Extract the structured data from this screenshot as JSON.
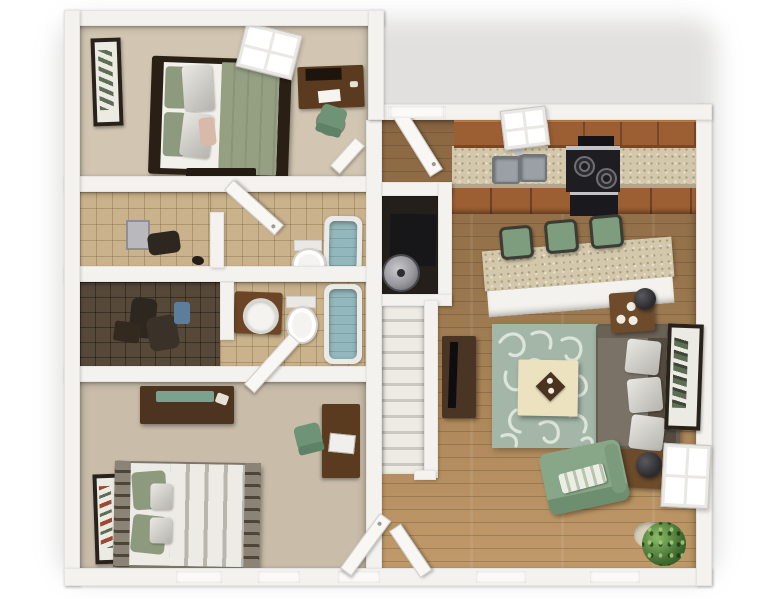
{
  "visible_text": [],
  "scene": {
    "type": "3d-apartment-floor-plan-render",
    "view": "top-down dollhouse cutaway, white exterior walls on white background",
    "rooms": [
      {
        "id": "bedroom-1",
        "position": "top-left",
        "floor": "beige carpet",
        "furniture": [
          "wall-art",
          "double-bed-sage-duvet",
          "white-pillows",
          "pink-accent-pillow",
          "foot-bench",
          "four-pane-window",
          "desk",
          "green-office-chair"
        ]
      },
      {
        "id": "closet-a",
        "position": "mid-left",
        "floor": "tan tile",
        "furniture": [
          "grey-wall-cabinet",
          "hanging-clothes"
        ]
      },
      {
        "id": "bathroom-a",
        "position": "mid-center-left",
        "floor": "tan tile",
        "furniture": [
          "open-door",
          "bathtub",
          "toilet"
        ]
      },
      {
        "id": "walk-in-closet",
        "position": "lower-mid-left",
        "floor": "dark tile",
        "furniture": [
          "hanging-clothes",
          "blue-towels",
          "bench"
        ]
      },
      {
        "id": "bathroom-b",
        "position": "lower-mid-center",
        "floor": "tan tile",
        "furniture": [
          "vanity-with-round-sink",
          "toilet",
          "bathtub",
          "open-door"
        ]
      },
      {
        "id": "bedroom-2",
        "position": "bottom-left",
        "floor": "taupe carpet",
        "furniture": [
          "dresser-with-teal-runner",
          "wall-art",
          "striped-duvet-bed",
          "sage-pillows",
          "desk",
          "green-office-chair",
          "two-windows",
          "open-door"
        ]
      },
      {
        "id": "utility-closet",
        "position": "center",
        "floor": "dark",
        "furniture": [
          "furnace",
          "water-heater"
        ]
      },
      {
        "id": "staircase",
        "position": "center",
        "furniture": [
          "white-treads",
          "railing-wall",
          "hall-door"
        ]
      },
      {
        "id": "kitchen",
        "position": "top-right",
        "floor": "hardwood",
        "furniture": [
          "entry-door",
          "upper-cabinets",
          "window",
          "granite-countertop",
          "double-sink",
          "range-hood",
          "black-stove",
          "base-cabinets"
        ]
      },
      {
        "id": "breakfast-bar",
        "position": "center-right",
        "furniture": [
          "granite-bar-top",
          "bar-stool",
          "bar-stool",
          "bar-stool"
        ]
      },
      {
        "id": "living-room",
        "position": "right",
        "floor": "hardwood",
        "furniture": [
          "tv-stand",
          "flat-tv",
          "damask-rug",
          "cream-coffee-table",
          "decor-tray",
          "sofa-with-three-pillows",
          "end-table-with-lamp",
          "end-table-with-candles",
          "wall-art",
          "four-pane-window",
          "green-armchair-striped-pillow",
          "potted-plant",
          "bottom-windows"
        ]
      }
    ]
  },
  "palette": {
    "bg": "#ffffff",
    "wall": "#f3f2ee",
    "thresh": "#fbfaf8",
    "door": "#f8f7f4",
    "door_edge": "#d0cec9",
    "carpet1": "#d2c6b2",
    "carpet2": "#c9bca9",
    "tile_light": "#c9b28c",
    "tile_dark": "#57493a",
    "wood1": "#8a6742",
    "wood2": "#c09a6a",
    "cab_top": "#c1844f",
    "cab_front": "#9c5f33",
    "cab_edge": "#7a4722",
    "counter": "#d3c8ab",
    "steel": "#c3c3c7",
    "stove": "#1e1e22",
    "burner": "#6e6e73",
    "sink": "#9aa0a5",
    "sink_edge": "#70767b",
    "stool": "#7e9c7e",
    "stool_edge": "#3c3c34",
    "rug": "#a3b6a7",
    "rug_pattern": "#ebf1e7",
    "ctable": "#ece2c0",
    "tray": "#4a3320",
    "sofa_seat": "#7b7267",
    "sofa_back": "#544b40",
    "sofa_arm": "#675e52",
    "armchair": "#87a788",
    "armchair_dark": "#6d8f70",
    "endtable": "#6d4b2b",
    "lamp": "#2b2b2e",
    "plant1": "#8cbb66",
    "plant2": "#3f6b2f",
    "pot": "#d8cfbc",
    "frame_dark": "#29221b",
    "art_bg": "#ebeae3",
    "art_green": "#5d6e55",
    "art_red": "#9c4a36",
    "bedframe": "#2a1f14",
    "duvet1": "#95a083",
    "pillow_sage": "#8e9a7e",
    "pink": "#d9b9a9",
    "duvet2": "#edebe5",
    "duvet2_stripe": "#b9b6ae",
    "bedframe2": "#7d7568",
    "desk": "#5a3b20",
    "chair_green": "#6f9377",
    "dresser": "#4c3420",
    "runner": "#7ba18f",
    "tub": "#92b7bc",
    "tub_rim": "#eceae6",
    "fixture": "#f4f3ef",
    "fixture_edge": "#d3d1cc",
    "vanity": "#6b4526",
    "heater": "#98989c",
    "furnace": "#17171a",
    "closet_floor": "#241f1a",
    "grey_cab": "#b9b9bd",
    "towel_blue": "#5d7d9a",
    "dark_cloth": "#2e2720",
    "stairs1": "#edebe4",
    "stairs2": "#cbc8c1"
  }
}
